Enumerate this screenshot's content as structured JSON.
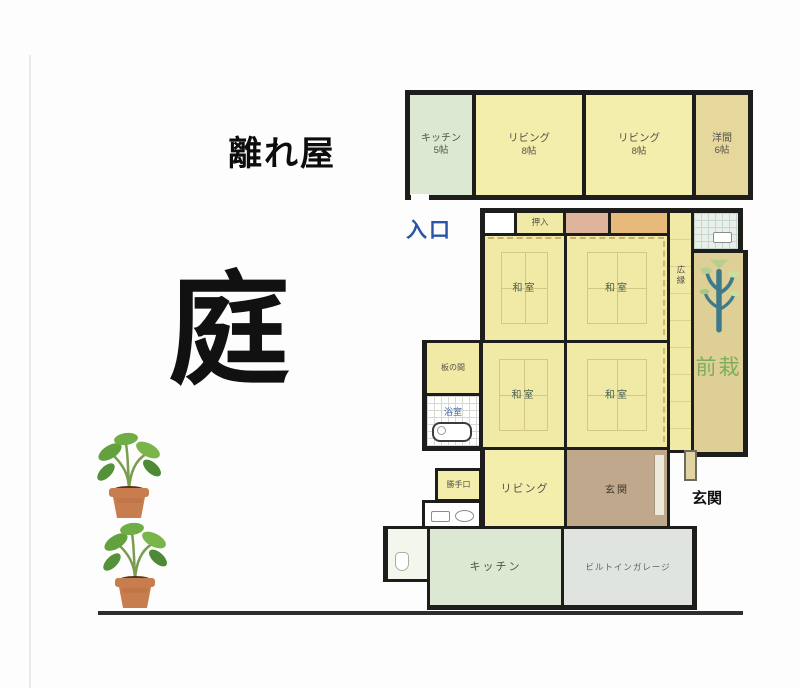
{
  "scene": {
    "niwa": "庭",
    "hanareya": "離れ屋",
    "iriguchi": "入口",
    "genkan_outside": "玄関"
  },
  "detached_house": {
    "rooms": [
      {
        "name": "キッチン",
        "size": "5帖"
      },
      {
        "name": "リビング",
        "size": "8帖"
      },
      {
        "name": "リビング",
        "size": "8帖"
      },
      {
        "name": "洋間",
        "size": "6帖"
      }
    ]
  },
  "main_house": {
    "oshiire": "押入",
    "washitsu_nw": "和室",
    "washitsu_ne": "和室",
    "washitsu_sw": "和室",
    "washitsu_se": "和室",
    "hiroen": "広縁",
    "sensai": "前栽",
    "itanoma": "板の間",
    "yokushitsu": "浴室",
    "katteguchi": "勝手口",
    "living": "リビング",
    "genkan": "玄関",
    "kitchen": "キッチン",
    "garage": "ビルトインガレージ"
  },
  "colors": {
    "wall": "#1d1d1b",
    "tatami_yellow": "#f1eaa6",
    "pale_yellow": "#f4eead",
    "green_room": "#dde8d2",
    "yoma_tan": "#e6d79c",
    "sensai_tan": "#ddcf96",
    "genkan_brown": "#bfa88c",
    "garage_gray": "#e0e4e0",
    "closet_pink": "#dfb49c",
    "closet_orange": "#e7ba7c",
    "entrance_blue": "#2b56a8",
    "sensai_green": "#7fae5a"
  }
}
